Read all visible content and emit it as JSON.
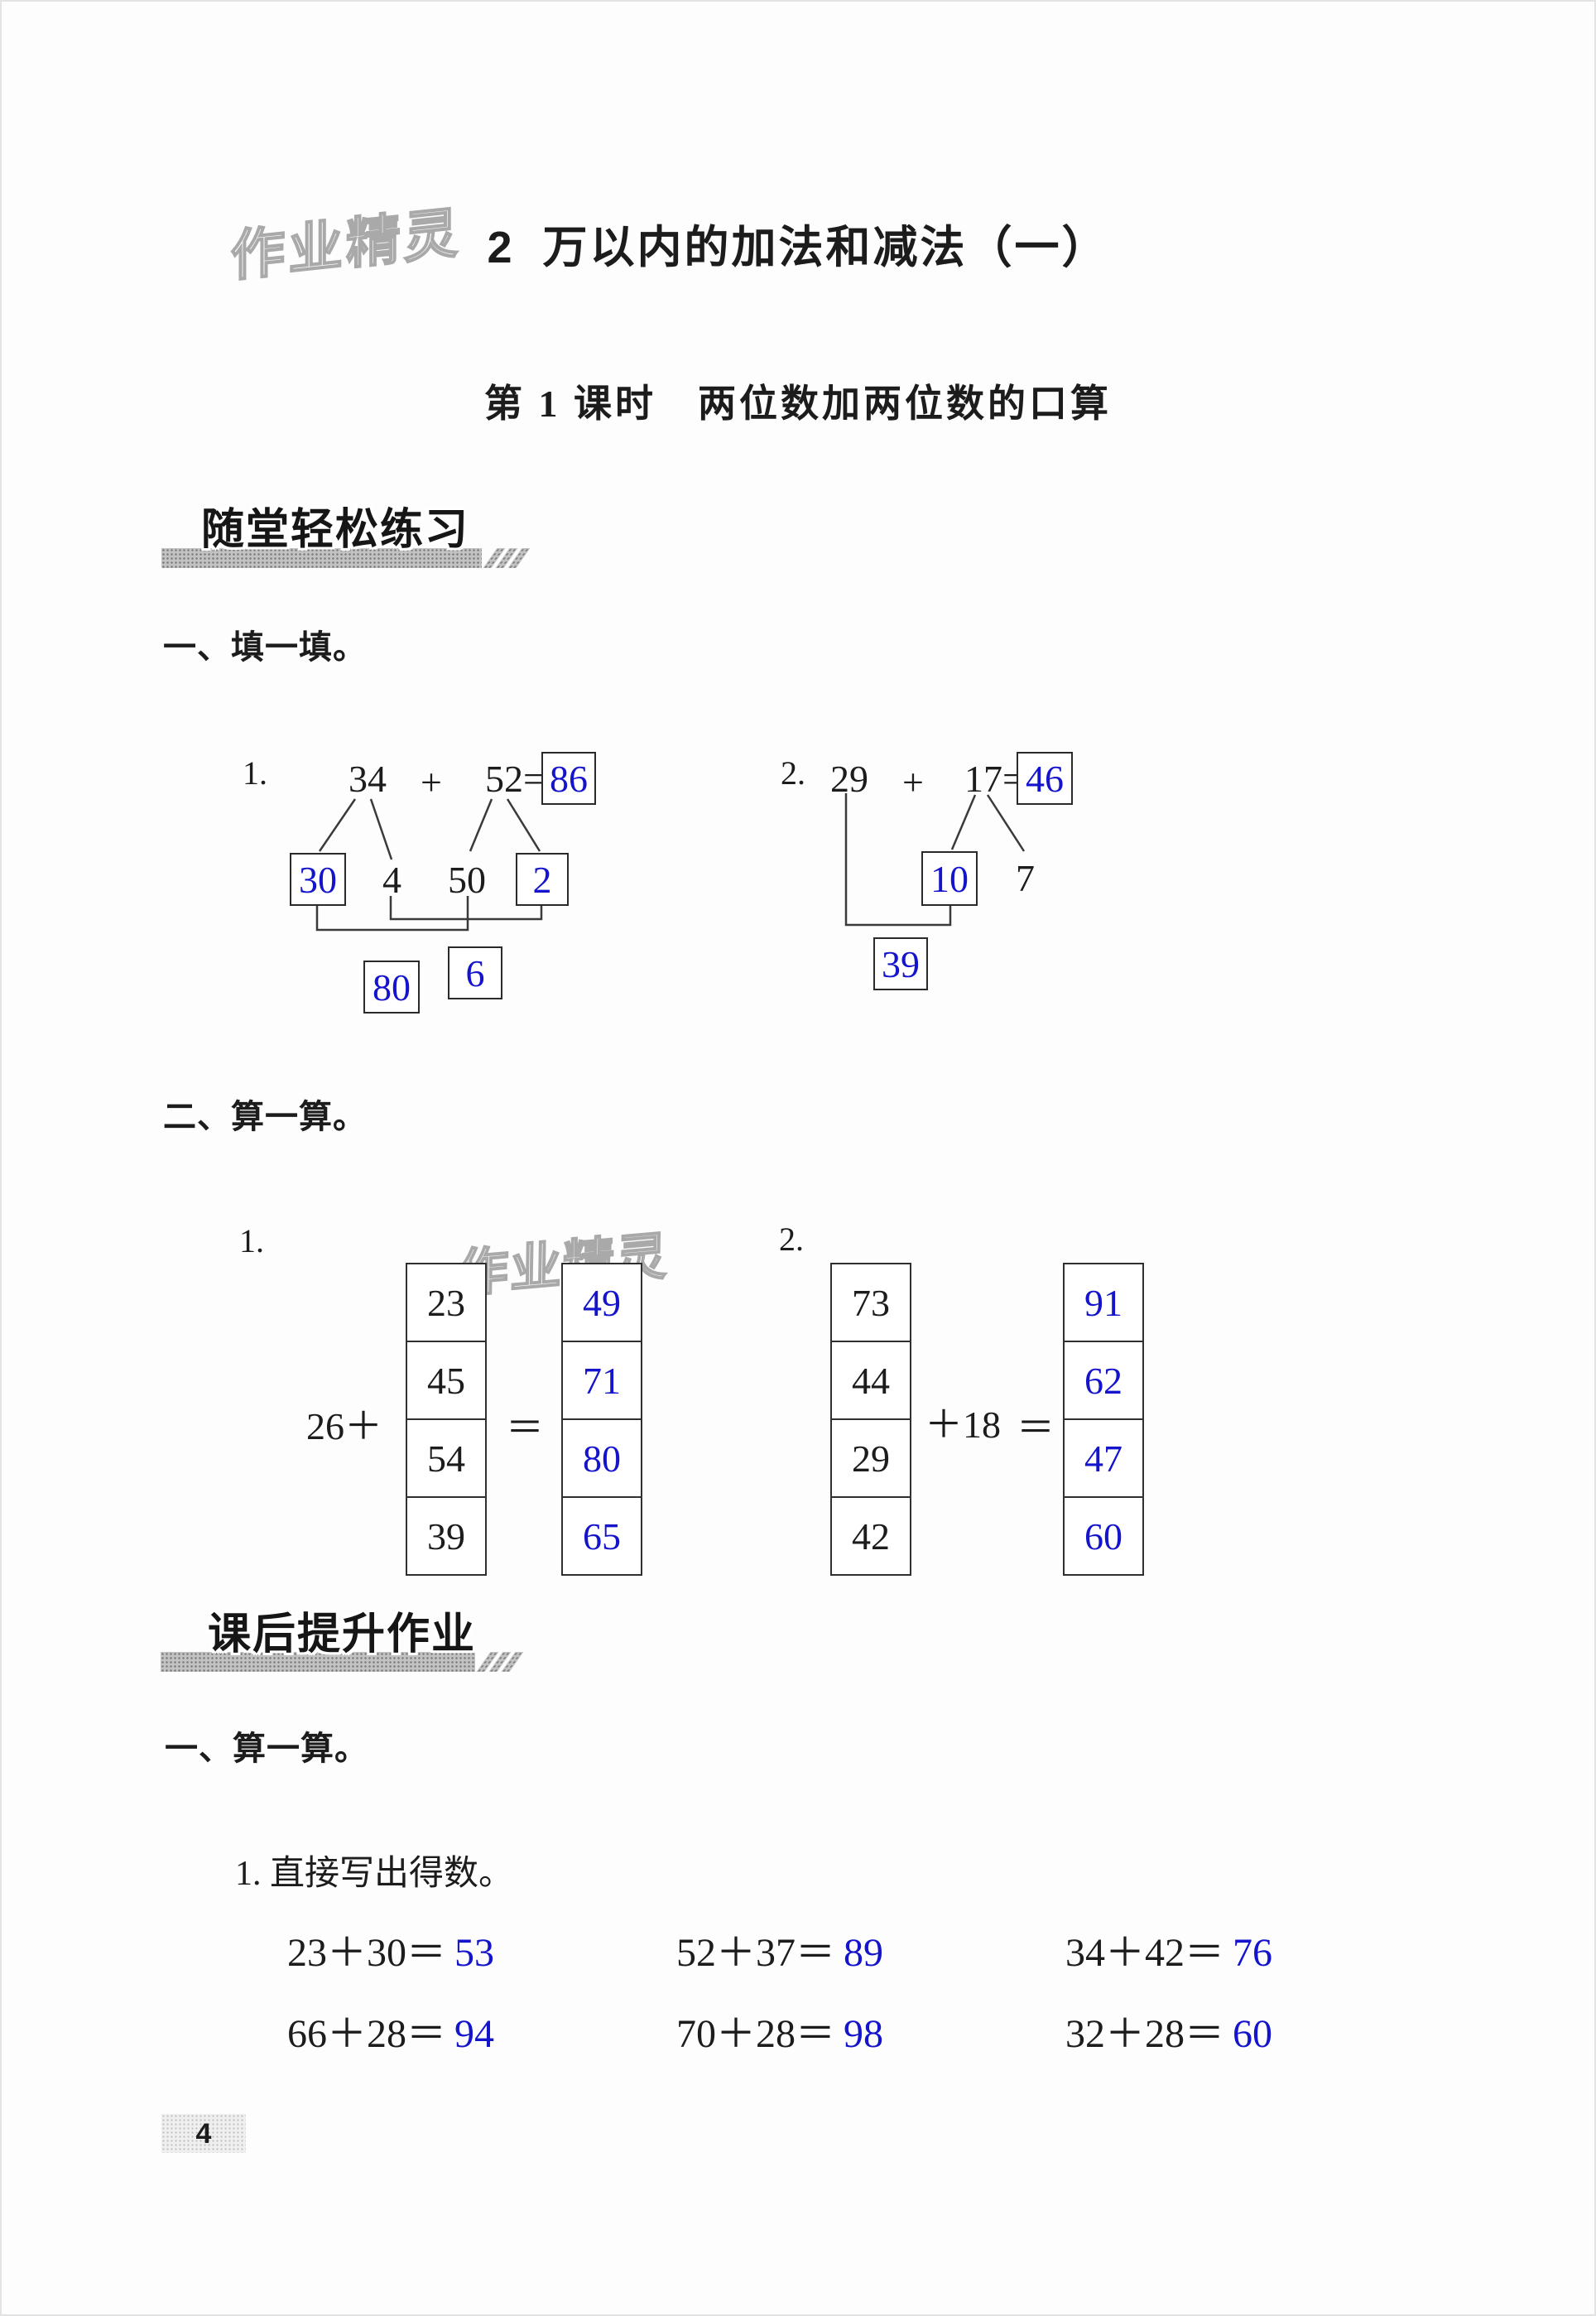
{
  "page": {
    "number": "4",
    "watermark": "作业精灵"
  },
  "header": {
    "chapter_number": "2",
    "chapter_title": "万以内的加法和减法（一）",
    "lesson_title": "第 1 课时　两位数加两位数的口算"
  },
  "classwork": {
    "banner": "随堂轻松练习",
    "q1": {
      "heading": "一、填一填。",
      "p1": {
        "label": "1.",
        "addend1": "34",
        "plus": "+",
        "addend2": "52=",
        "sum": "86",
        "tens1": "30",
        "ones1": "4",
        "tens2": "50",
        "ones2": "2",
        "tens_sum": "80",
        "ones_sum": "6"
      },
      "p2": {
        "label": "2.",
        "addend1": "29",
        "plus": "+",
        "addend2": "17=",
        "sum": "46",
        "tens2": "10",
        "ones2": "7",
        "partial_sum": "39"
      }
    },
    "q2": {
      "heading": "二、算一算。",
      "t1": {
        "label": "1.",
        "prefix": "26＋",
        "equals": "＝",
        "addends": [
          "23",
          "45",
          "54",
          "39"
        ],
        "sums": [
          "49",
          "71",
          "80",
          "65"
        ]
      },
      "t2": {
        "label": "2.",
        "suffix": "＋18",
        "equals": "＝",
        "addends": [
          "73",
          "44",
          "29",
          "42"
        ],
        "sums": [
          "91",
          "62",
          "47",
          "60"
        ]
      }
    }
  },
  "homework": {
    "banner": "课后提升作业",
    "q1": {
      "heading": "一、算一算。",
      "sub1": {
        "heading": "1. 直接写出得数。",
        "equations": [
          {
            "expr": "23＋30＝",
            "answer": "53"
          },
          {
            "expr": "52＋37＝",
            "answer": "89"
          },
          {
            "expr": "34＋42＝",
            "answer": "76"
          },
          {
            "expr": "66＋28＝",
            "answer": "94"
          },
          {
            "expr": "70＋28＝",
            "answer": "98"
          },
          {
            "expr": "32＋28＝",
            "answer": "60"
          }
        ]
      }
    }
  },
  "colors": {
    "answer_blue": "#1414cc",
    "ink_black": "#1c1c1c"
  }
}
